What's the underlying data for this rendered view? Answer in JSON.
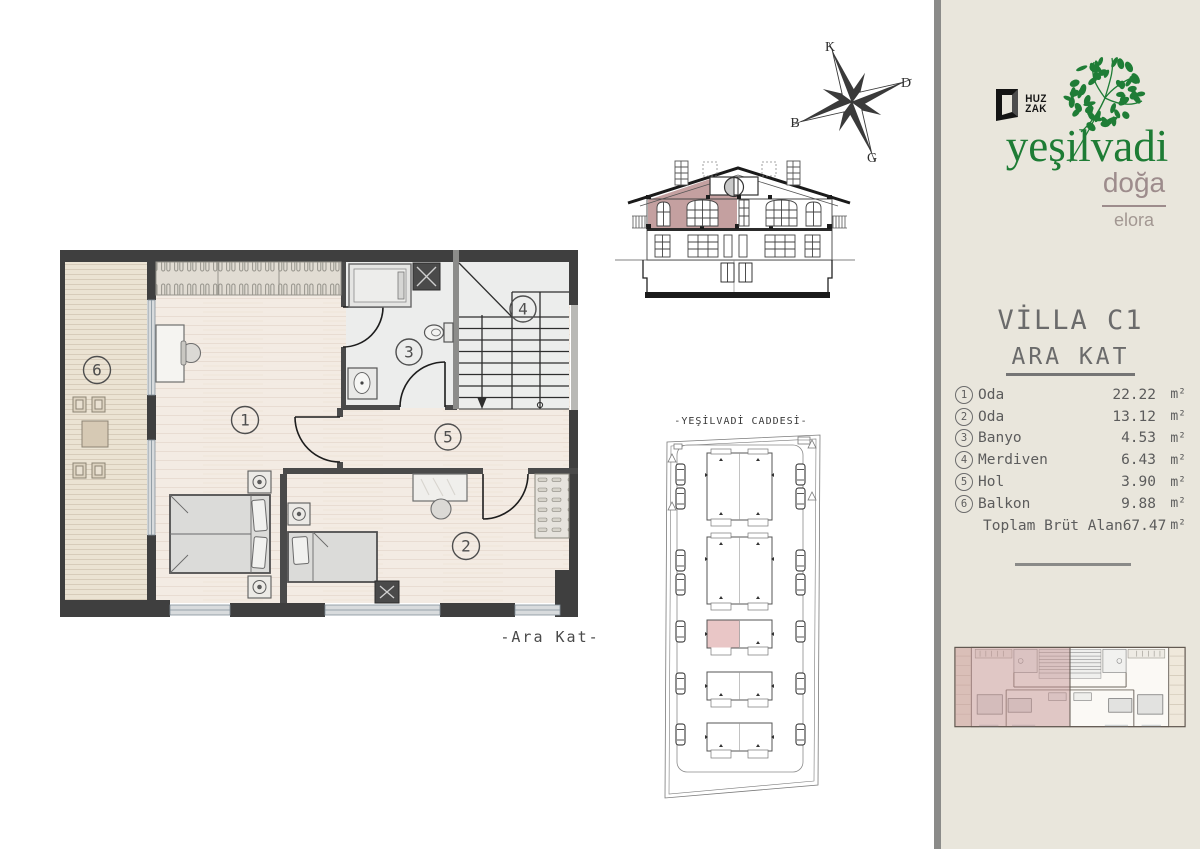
{
  "brand": {
    "logo_top": "HUZ",
    "logo_bottom": "ZAK",
    "name": "yeşilvadi",
    "tagline": "doğa",
    "edition": "elora",
    "green": "#1e7c35",
    "rose": "#9d8c8c"
  },
  "panel": {
    "villa_title": "VİLLA C1",
    "floor_title": "ARA KAT",
    "rooms": [
      {
        "num": "1",
        "label": "Oda",
        "area": "22.22",
        "unit": "m²"
      },
      {
        "num": "2",
        "label": "Oda",
        "area": "13.12",
        "unit": "m²"
      },
      {
        "num": "3",
        "label": "Banyo",
        "area": "4.53",
        "unit": "m²"
      },
      {
        "num": "4",
        "label": "Merdiven",
        "area": "6.43",
        "unit": "m²"
      },
      {
        "num": "5",
        "label": "Hol",
        "area": "3.90",
        "unit": "m²"
      },
      {
        "num": "6",
        "label": "Balkon",
        "area": "9.88",
        "unit": "m²"
      }
    ],
    "total": {
      "label": "Toplam Brüt Alan",
      "area": "67.47",
      "unit": "m²"
    }
  },
  "plan": {
    "caption": "-Ara Kat-",
    "numbers": [
      "1",
      "2",
      "3",
      "4",
      "5",
      "6"
    ]
  },
  "site": {
    "street": "-YEŞİLVADİ CADDESİ-"
  },
  "compass": {
    "n": "K",
    "e": "D",
    "s": "G",
    "w": "B"
  },
  "colors": {
    "wall": "#3f3f3f",
    "highlight": "#c4a0a0",
    "site_highlight": "#e9c6c6",
    "cream": "#e9e6dc"
  }
}
